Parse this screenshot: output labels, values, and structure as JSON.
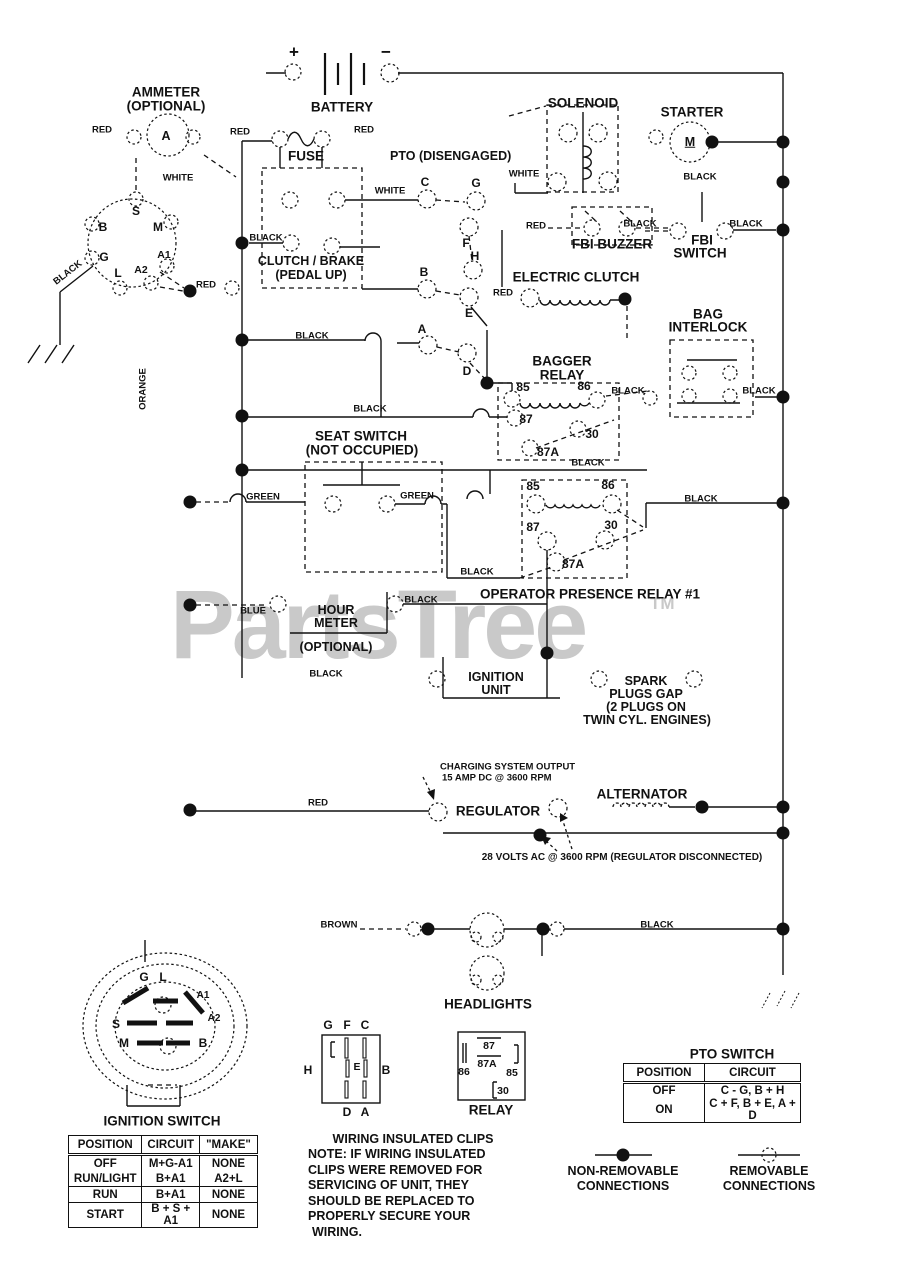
{
  "watermark": {
    "brand": "PartsTree",
    "tm": "TM"
  },
  "wire_colors": {
    "red": "RED",
    "white": "WHITE",
    "black": "BLACK",
    "green": "GREEN",
    "orange": "ORANGE",
    "blue": "BLUE",
    "brown": "BROWN"
  },
  "pins": {
    "p85": "85",
    "p86": "86",
    "p87": "87",
    "p87a": "87A",
    "p30": "30",
    "a": "A",
    "b": "B",
    "c": "C",
    "d": "D",
    "e": "E",
    "f": "F",
    "g": "G",
    "h": "H",
    "l": "L",
    "m": "M",
    "s": "S",
    "a1": "A1",
    "a2": "A2",
    "plus": "+",
    "minus": "−"
  },
  "components": {
    "ammeter_line1": "AMMETER",
    "ammeter_line2": "(OPTIONAL)",
    "ammeter_letter": "A",
    "battery": "BATTERY",
    "fuse": "FUSE",
    "pto_disengaged": "PTO (DISENGAGЕD)",
    "solenoid": "SOLENOID",
    "starter": "STARTER",
    "starter_letter": "M",
    "fbi_buzzer": "FBI BUZZER",
    "fbi_switch_line1": "FBI",
    "fbi_switch_line2": "SWITCH",
    "clutch_brake_line1": "CLUTCH / BRAKE",
    "clutch_brake_line2": "(PEDAL UP)",
    "electric_clutch": "ELECTRIC CLUTCH",
    "bag_interlock_line1": "BAG",
    "bag_interlock_line2": "INTERLOCK",
    "bagger_relay_line1": "BAGGER",
    "bagger_relay_line2": "RELAY",
    "seat_switch_line1": "SEAT SWITCH",
    "seat_switch_line2": "(NOT OCCUPIED)",
    "operator_relay": "OPERATOR PRESENCE RELAY #1",
    "hour_meter_line1": "HOUR",
    "hour_meter_line2": "METER",
    "hour_meter_line3": "(OPTIONAL)",
    "ignition_unit_line1": "IGNITION",
    "ignition_unit_line2": "UNIT",
    "spark_line1": "SPARK",
    "spark_line2": "PLUGS GAP",
    "spark_line3": "(2 PLUGS ON",
    "spark_line4": "TWIN CYL. ENGINES)",
    "charging_line1": "CHARGING SYSTEM OUTPUT",
    "charging_line2": "15 AMP DC @ 3600 RPM",
    "regulator": "REGULATOR",
    "alternator": "ALTERNATOR",
    "volts_note": "28 VOLTS AC @ 3600 RPM (REGULATOR DISCONNECTED)",
    "headlights": "HEADLIGHTS",
    "relay": "RELAY"
  },
  "ignition_table": {
    "title": "IGNITION SWITCH",
    "headers": [
      "POSITION",
      "CIRCUIT",
      "\"MAKE\""
    ],
    "rows": [
      [
        "OFF",
        "M+G-A1",
        "NONE"
      ],
      [
        "RUN/LIGHT",
        "B+A1",
        "A2+L"
      ],
      [
        "RUN",
        "B+A1",
        "NONE"
      ],
      [
        "START",
        "B + S + A1",
        "NONE"
      ]
    ]
  },
  "pto_table": {
    "title": "PTO SWITCH",
    "headers": [
      "POSITION",
      "CIRCUIT"
    ],
    "rows": [
      [
        "OFF",
        "C - G, B + H"
      ],
      [
        "ON",
        "C + F, B + E, A + D"
      ]
    ]
  },
  "note": {
    "title": "WIRING INSULATED CLIPS",
    "lines": [
      "NOTE: IF WIRING INSULATED",
      "CLIPS WERE REMOVED FOR",
      "SERVICING OF UNIT, THEY",
      "SHOULD BE REPLACED TO",
      "PROPERLY SECURE YOUR",
      "WIRING."
    ]
  },
  "legend": {
    "nonremovable_line1": "NON-REMOVABLE",
    "nonremovable_line2": "CONNECTIONS",
    "removable_line1": "REMOVABLE",
    "removable_line2": "CONNECTIONS"
  }
}
